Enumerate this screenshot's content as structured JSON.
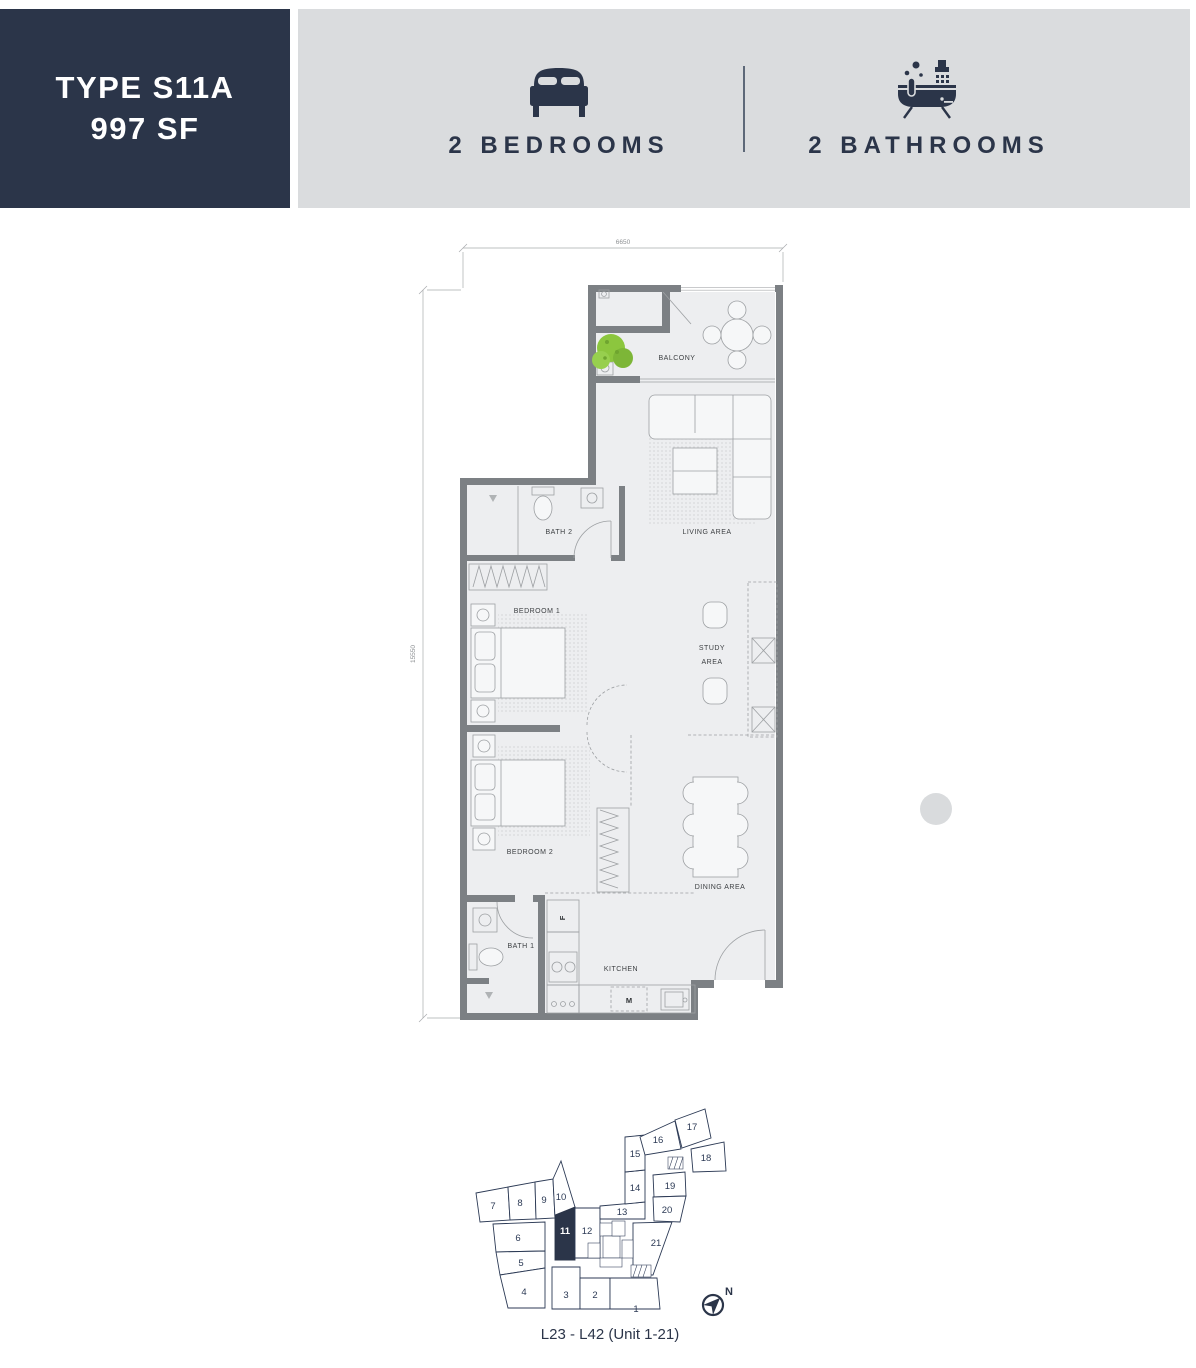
{
  "unit_card": {
    "type": "TYPE S11A",
    "size": "997 SF"
  },
  "features": {
    "bedrooms_label": "2 BEDROOMS",
    "bathrooms_label": "2 BATHROOMS"
  },
  "floorplan": {
    "dimensions": {
      "width": "6650",
      "height": "15550"
    },
    "rooms": {
      "balcony": "BALCONY",
      "living": "LIVING AREA",
      "bath2": "BATH 2",
      "bedroom1": "BEDROOM 1",
      "study_line1": "STUDY",
      "study_line2": "AREA",
      "bedroom2": "BEDROOM 2",
      "dining": "DINING AREA",
      "bath1": "BATH 1",
      "kitchen": "KITCHEN"
    },
    "appliances": {
      "fridge": "F",
      "washer": "M"
    }
  },
  "keyplan": {
    "units": [
      "1",
      "2",
      "3",
      "4",
      "5",
      "6",
      "7",
      "8",
      "9",
      "10",
      "11",
      "12",
      "13",
      "14",
      "15",
      "16",
      "17",
      "18",
      "19",
      "20",
      "21"
    ],
    "highlighted_unit": "11",
    "caption": "L23 - L42 (Unit 1-21)",
    "north": "N"
  },
  "colors": {
    "navy": "#2b3549",
    "band_gray": "#dadcde",
    "floor_gray": "#edeef0",
    "wall_gray": "#7c8084",
    "plant_green": "#8cc63e"
  }
}
